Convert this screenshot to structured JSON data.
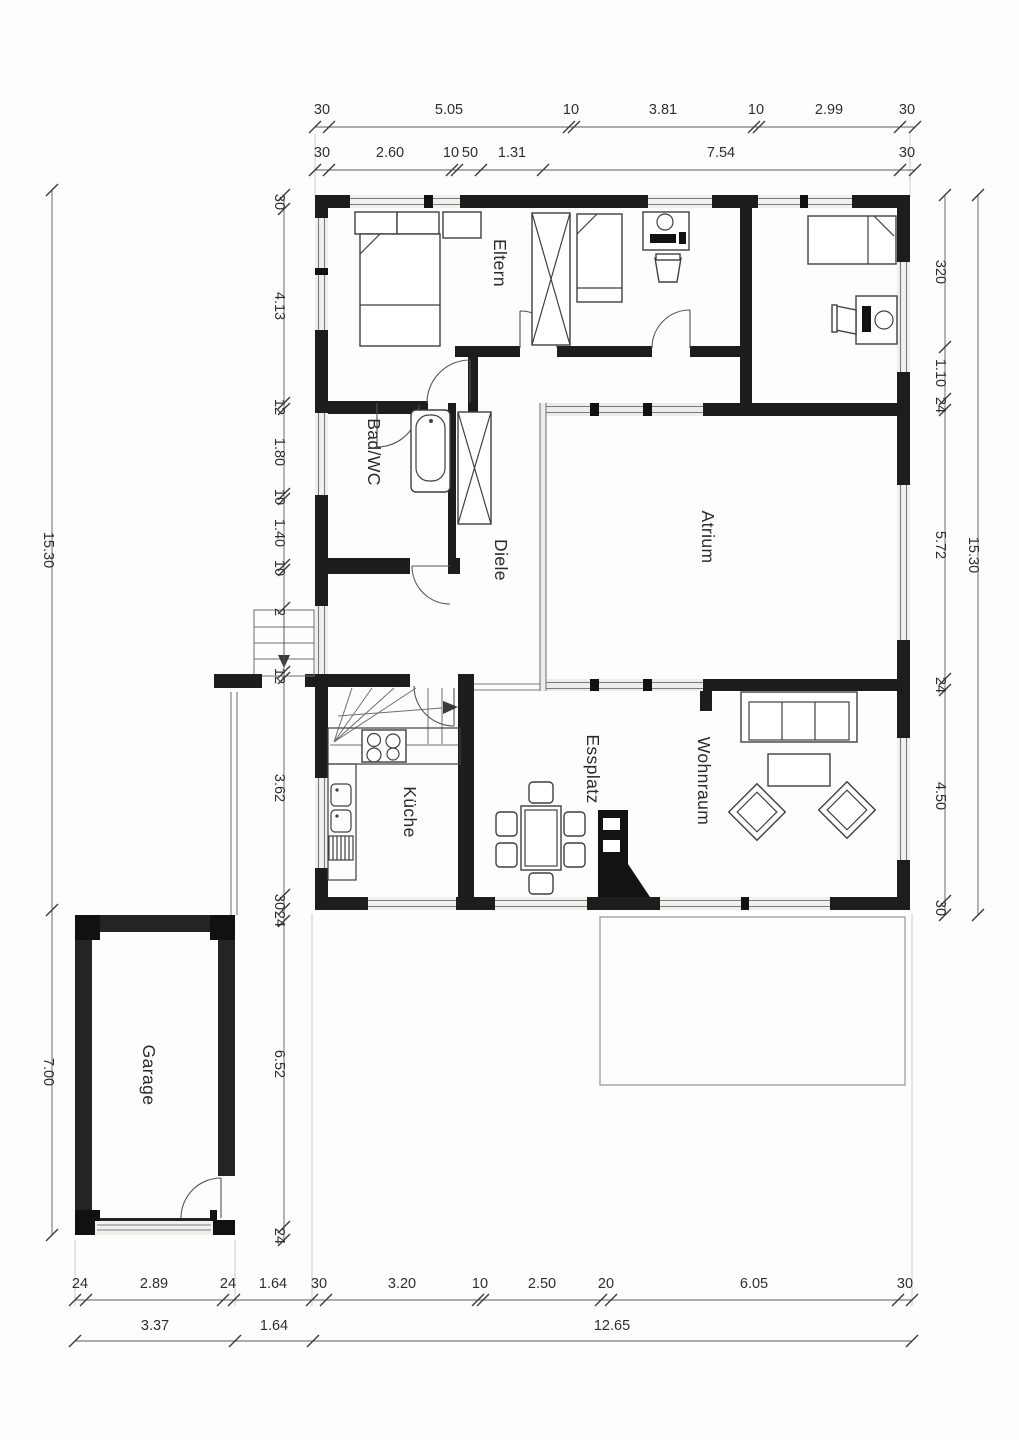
{
  "rooms": {
    "eltern": "Eltern",
    "bad_wc": "Bad/WC",
    "diele": "Diele",
    "atrium": "Atrium",
    "kueche": "Küche",
    "essplatz": "Essplatz",
    "wohnraum": "Wohnraum",
    "garage": "Garage"
  },
  "dims": {
    "top1": [
      "30",
      "5.05",
      "10",
      "3.81",
      "10",
      "2.99",
      "30"
    ],
    "top2": [
      "30",
      "2.60",
      "10",
      "50",
      "1.31",
      "7.54",
      "30"
    ],
    "bottom1": [
      "24",
      "2.89",
      "24",
      "1.64",
      "30",
      "3.20",
      "10",
      "2.50",
      "20",
      "6.05",
      "30"
    ],
    "bottom2": [
      "3.37",
      "1.64",
      "12.65"
    ],
    "left_outer": [
      "15.30",
      "7.00"
    ],
    "left_inner": [
      "30",
      "4.13",
      "12",
      "1.80",
      "10",
      "1.40",
      "10",
      "2",
      "12",
      "3.62",
      "30",
      "24",
      "6.52",
      "24"
    ],
    "right_inner": [
      "320",
      "1.10",
      "24",
      "5.72",
      "24",
      "4.50",
      "30"
    ],
    "right_outer": [
      "15.30"
    ]
  }
}
